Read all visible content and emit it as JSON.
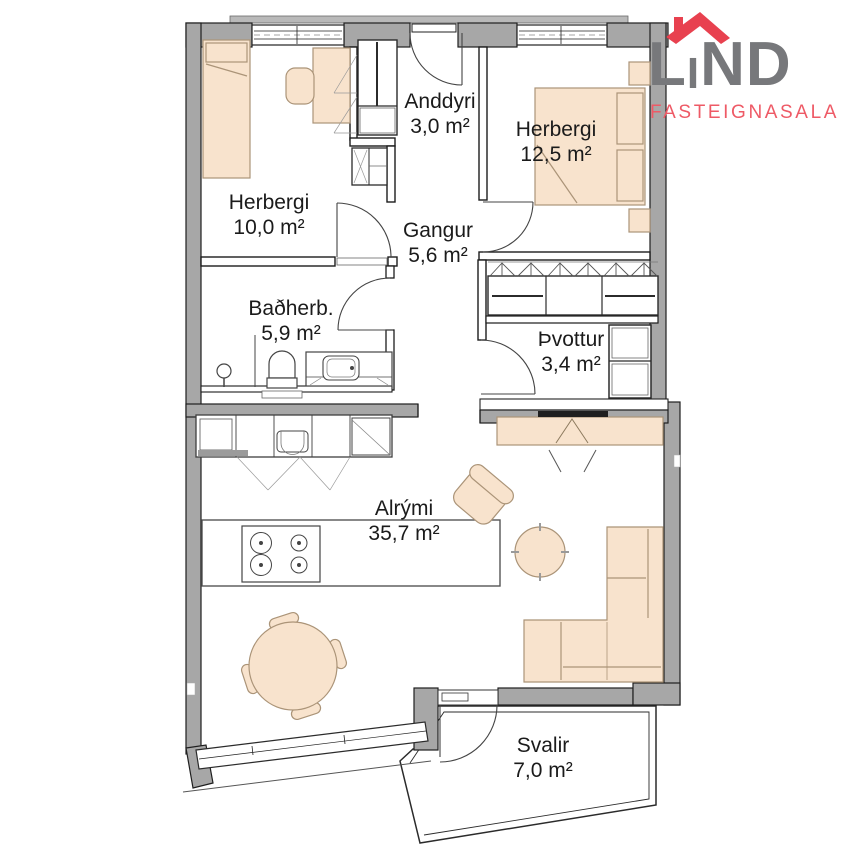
{
  "logo": {
    "brand_l": "L",
    "brand_i": "I",
    "brand_nd": "ND",
    "subtitle": "FASTEIGNASALA",
    "colors": {
      "brand_gray": "#77787b",
      "roof_red": "#e8414f",
      "subtitle_red": "#ee5a66"
    }
  },
  "floor_plan": {
    "rooms": [
      {
        "id": "anddyri",
        "name": "Anddyri",
        "area": "3,0 m²"
      },
      {
        "id": "herbergi2",
        "name": "Herbergi",
        "area": "12,5 m²"
      },
      {
        "id": "herbergi1",
        "name": "Herbergi",
        "area": "10,0 m²"
      },
      {
        "id": "gangur",
        "name": "Gangur",
        "area": "5,6 m²"
      },
      {
        "id": "badherb",
        "name": "Baðherb.",
        "area": "5,9 m²"
      },
      {
        "id": "thvottur",
        "name": "Þvottur",
        "area": "3,4 m²"
      },
      {
        "id": "alrymi",
        "name": "Alrými",
        "area": "35,7 m²"
      },
      {
        "id": "svalir",
        "name": "Svalir",
        "area": "7,0 m²"
      }
    ],
    "colors": {
      "wall_gray": "#a7a7a7",
      "furniture_tan": "#f8e3cd",
      "line_dark": "#1f1f1f"
    }
  }
}
